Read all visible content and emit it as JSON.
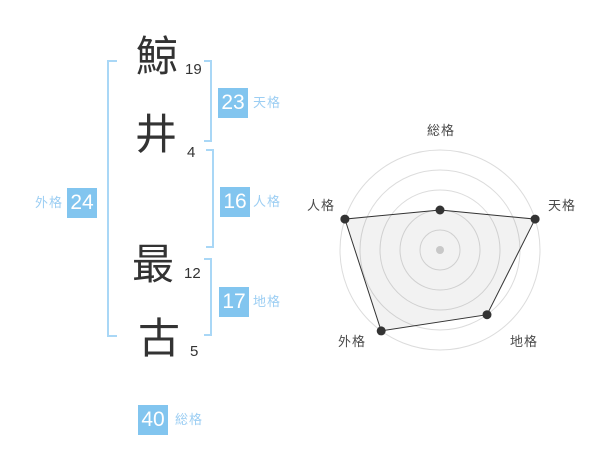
{
  "colors": {
    "badge_bg": "#82C5EF",
    "badge_text": "#FFFFFF",
    "kaku_label": "#9CCEF3",
    "bracket": "#A9D7F6",
    "char_text": "#333333",
    "stroke_text": "#333333",
    "chart_label": "#4A4A4A",
    "ring_stroke": "#DCDCDC",
    "polygon_stroke": "#333333",
    "polygon_fill": "rgba(0,0,0,0.05)",
    "point_fill": "#333333",
    "center_dot": "#C8C8C8"
  },
  "name": {
    "characters": [
      {
        "char": "鯨",
        "strokes": "19"
      },
      {
        "char": "井",
        "strokes": "4"
      },
      {
        "char": "最",
        "strokes": "12"
      },
      {
        "char": "古",
        "strokes": "5"
      }
    ]
  },
  "kaku": {
    "tenkaku": {
      "value": "23",
      "label": "天格"
    },
    "jinkaku": {
      "value": "16",
      "label": "人格"
    },
    "chikaku": {
      "value": "17",
      "label": "地格"
    },
    "gaikaku": {
      "value": "24",
      "label": "外格"
    },
    "soukaku": {
      "value": "40",
      "label": "総格"
    }
  },
  "chart_data": {
    "type": "radar",
    "axes": [
      "総格",
      "天格",
      "地格",
      "外格",
      "人格"
    ],
    "kaku_values": [
      40,
      23,
      17,
      24,
      16
    ],
    "scores": [
      2,
      5,
      4,
      5,
      5
    ],
    "score_max": 5,
    "rings": 5,
    "ring_radii_fraction": [
      0.2,
      0.4,
      0.6,
      0.8,
      1.0
    ],
    "start_angle_deg": 90,
    "direction": "clockwise",
    "grid": "concentric-circles",
    "spokes": false,
    "legend": "none",
    "center_marker": true
  }
}
